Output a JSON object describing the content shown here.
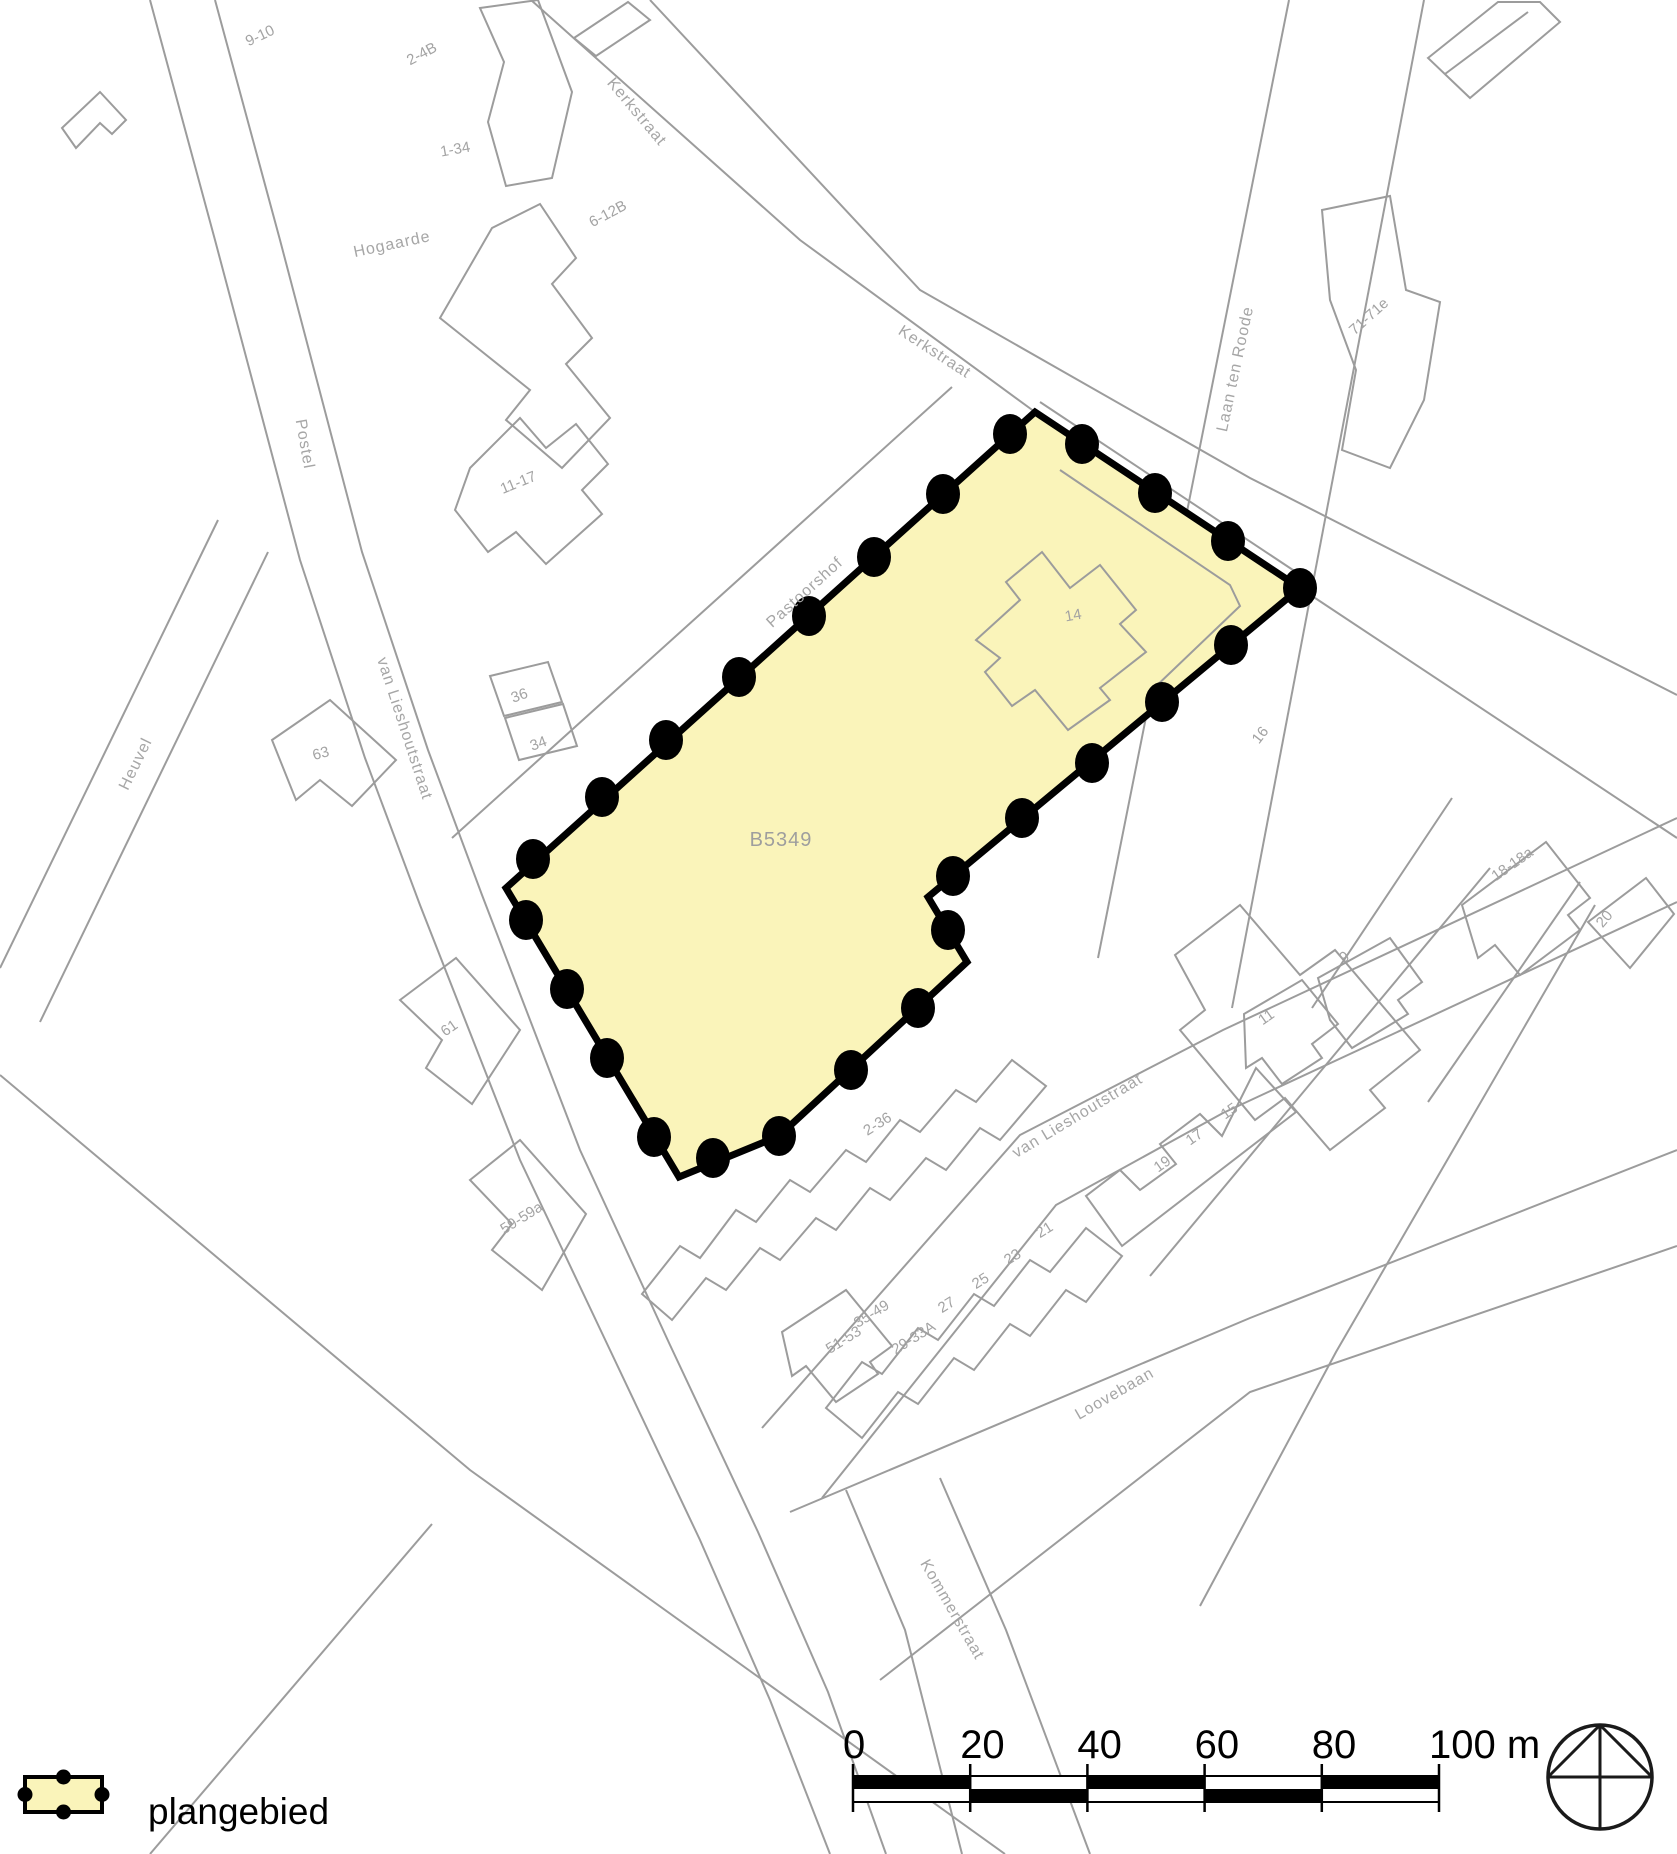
{
  "canvas": {
    "width": 1677,
    "height": 1854
  },
  "colors": {
    "background": "#ffffff",
    "map_line": "#9c9c9c",
    "map_label": "#a6a6a6",
    "plan_fill": "#faf4ba",
    "plan_border": "#000000"
  },
  "plan_area": {
    "parcel_code": "B5349",
    "code_x": 781,
    "code_y": 846,
    "polygon": [
      [
        1035,
        412
      ],
      [
        1300,
        588
      ],
      [
        928,
        897
      ],
      [
        967,
        962
      ],
      [
        779,
        1136
      ],
      [
        679,
        1177
      ],
      [
        506,
        888
      ]
    ],
    "border_width": 7,
    "dots": [
      [
        1082,
        444
      ],
      [
        1155,
        493
      ],
      [
        1228,
        541
      ],
      [
        1300,
        588
      ],
      [
        1231,
        645
      ],
      [
        1162,
        702
      ],
      [
        1092,
        763
      ],
      [
        1022,
        818
      ],
      [
        953,
        876
      ],
      [
        948,
        930
      ],
      [
        918,
        1008
      ],
      [
        851,
        1070
      ],
      [
        779,
        1136
      ],
      [
        713,
        1158
      ],
      [
        654,
        1137
      ],
      [
        607,
        1058
      ],
      [
        567,
        989
      ],
      [
        526,
        920
      ],
      [
        533,
        859
      ],
      [
        602,
        797
      ],
      [
        666,
        740
      ],
      [
        739,
        677
      ],
      [
        809,
        616
      ],
      [
        874,
        557
      ],
      [
        943,
        494
      ],
      [
        1010,
        434
      ]
    ],
    "dot_rx": 17,
    "dot_ry": 20
  },
  "street_labels": [
    {
      "text": "Kerkstraat",
      "x": 633,
      "y": 115,
      "rot": 50
    },
    {
      "text": "Kerkstraat",
      "x": 932,
      "y": 356,
      "rot": 33
    },
    {
      "text": "Laan ten Roode",
      "x": 1240,
      "y": 370,
      "rot": -78
    },
    {
      "text": "Postel",
      "x": 300,
      "y": 445,
      "rot": 80
    },
    {
      "text": "Hogaarde",
      "x": 393,
      "y": 249,
      "rot": -12
    },
    {
      "text": "Heuvel",
      "x": 140,
      "y": 766,
      "rot": -64
    },
    {
      "text": "van Lieshoutstraat",
      "x": 400,
      "y": 730,
      "rot": 72
    },
    {
      "text": "Pastoorshof",
      "x": 808,
      "y": 596,
      "rot": -42
    },
    {
      "text": "van Lieshoutstraat",
      "x": 1080,
      "y": 1120,
      "rot": -31
    },
    {
      "text": "Loovebaan",
      "x": 1117,
      "y": 1398,
      "rot": -30
    },
    {
      "text": "Kommerstraat",
      "x": 948,
      "y": 1612,
      "rot": 60
    }
  ],
  "parcel_labels": [
    {
      "text": "9-10",
      "x": 262,
      "y": 40,
      "rot": -25
    },
    {
      "text": "2-4B",
      "x": 424,
      "y": 58,
      "rot": -28
    },
    {
      "text": "1-34",
      "x": 456,
      "y": 154,
      "rot": -10
    },
    {
      "text": "6-12B",
      "x": 610,
      "y": 218,
      "rot": -28
    },
    {
      "text": "71-71e",
      "x": 1372,
      "y": 320,
      "rot": -42
    },
    {
      "text": "11-17",
      "x": 520,
      "y": 487,
      "rot": -22
    },
    {
      "text": "36",
      "x": 521,
      "y": 700,
      "rot": -20
    },
    {
      "text": "34",
      "x": 540,
      "y": 748,
      "rot": -20
    },
    {
      "text": "63",
      "x": 322,
      "y": 758,
      "rot": -15
    },
    {
      "text": "61",
      "x": 452,
      "y": 1032,
      "rot": -35
    },
    {
      "text": "59-59a",
      "x": 524,
      "y": 1222,
      "rot": -32
    },
    {
      "text": "14",
      "x": 1074,
      "y": 620,
      "rot": -10
    },
    {
      "text": "16",
      "x": 1264,
      "y": 738,
      "rot": -52
    },
    {
      "text": "18-18a",
      "x": 1515,
      "y": 868,
      "rot": -35
    },
    {
      "text": "20",
      "x": 1608,
      "y": 922,
      "rot": -50
    },
    {
      "text": "9",
      "x": 1347,
      "y": 961,
      "rot": -35
    },
    {
      "text": "11",
      "x": 1269,
      "y": 1021,
      "rot": -35
    },
    {
      "text": "15",
      "x": 1232,
      "y": 1115,
      "rot": -35
    },
    {
      "text": "17",
      "x": 1197,
      "y": 1141,
      "rot": -35
    },
    {
      "text": "19",
      "x": 1165,
      "y": 1168,
      "rot": -35
    },
    {
      "text": "2-36",
      "x": 880,
      "y": 1128,
      "rot": -32
    },
    {
      "text": "21",
      "x": 1047,
      "y": 1234,
      "rot": -32
    },
    {
      "text": "23",
      "x": 1015,
      "y": 1261,
      "rot": -32
    },
    {
      "text": "25",
      "x": 983,
      "y": 1285,
      "rot": -32
    },
    {
      "text": "27",
      "x": 949,
      "y": 1309,
      "rot": -32
    },
    {
      "text": "29-33A",
      "x": 916,
      "y": 1342,
      "rot": -32
    },
    {
      "text": "35-49",
      "x": 874,
      "y": 1318,
      "rot": -32
    },
    {
      "text": "51-53",
      "x": 846,
      "y": 1344,
      "rot": -32
    }
  ],
  "roads": [
    "M 531,0 L 800,240 L 1035,412",
    "M 1040,402 L 1308,580",
    "M 1300,588 L 1677,838",
    "M 650,0 L 920,290 L 1250,478 L 1677,695",
    "M 1289,0 L 1098,958",
    "M 1424,0 L 1232,1008",
    "M 150,0 L 215,240 L 300,560 L 365,758 L 420,905 L 520,1160 L 610,1350 L 700,1540 L 770,1700 L 830,1854",
    "M 215,0 L 280,240 L 362,552 L 428,750 L 482,895 L 580,1150 L 670,1345 L 758,1532 L 828,1692 L 886,1854",
    "M 218,520 L 0,968",
    "M 268,552 L 40,1022",
    "M 452,838 L 952,387",
    "M 762,1428 L 1020,1135 L 1223,1030 L 1677,818",
    "M 822,1498 L 1056,1205 L 1223,1113 L 1677,902",
    "M 790,1512 L 1250,1318 L 1677,1150",
    "M 880,1680 L 1250,1392 L 1677,1246",
    "M 846,1490 L 905,1630 L 962,1854",
    "M 940,1478 L 1006,1630 L 1090,1854",
    "M 0,1075 L 470,1470 L 1005,1854",
    "M 150,1854 L 432,1524",
    "M 1490,868 L 1150,1276",
    "M 1595,905 L 1336,1352 L 1200,1606",
    "M 1445,74 L 1528,12",
    "M 1452,798 L 1312,1008",
    "M 1580,882 L 1428,1102"
  ],
  "buildings": [
    {
      "name": "building-9-10",
      "d": "M 480,8 L 538,0 L 572,92 L 552,178 L 506,186 L 488,122 L 504,62 Z"
    },
    {
      "name": "building-1-34",
      "d": "M 440,318 L 492,228 L 540,204 L 576,258 L 552,284 L 592,338 L 566,364 L 610,418 L 562,468 L 506,420 L 530,390 L 480,350 Z"
    },
    {
      "name": "building-11-17",
      "d": "M 470,468 L 520,418 L 546,448 L 576,424 L 608,464 L 582,490 L 602,514 L 546,564 L 516,532 L 488,552 L 455,510 Z"
    },
    {
      "name": "parcel-36",
      "d": "M 490,676 L 548,662 L 562,702 L 504,716 Z"
    },
    {
      "name": "parcel-34",
      "d": "M 505,718 L 563,704 L 577,746 L 519,760 Z"
    },
    {
      "name": "building-63",
      "d": "M 272,740 L 330,700 L 396,760 L 352,806 L 320,780 L 296,800 Z"
    },
    {
      "name": "building-61",
      "d": "M 400,1000 L 456,958 L 520,1030 L 472,1104 L 426,1068 L 442,1040 Z"
    },
    {
      "name": "building-59-59a",
      "d": "M 470,1180 L 520,1140 L 586,1214 L 542,1290 L 492,1250 L 512,1224 Z"
    },
    {
      "name": "building-71-71e",
      "d": "M 1322,210 L 1390,196 L 1406,290 L 1440,302 L 1424,400 L 1390,468 L 1342,450 L 1356,370 L 1330,300 Z"
    },
    {
      "name": "building-16",
      "d": "M 1175,955 L 1240,905 L 1300,975 L 1335,950 L 1420,1050 L 1370,1090 L 1385,1108 L 1330,1150 L 1285,1098 L 1255,1120 L 1180,1030 L 1205,1010 Z"
    },
    {
      "name": "building-18-18a",
      "d": "M 1462,905 L 1546,842 L 1590,898 L 1568,915 L 1580,930 L 1520,975 L 1495,945 L 1478,958 Z"
    },
    {
      "name": "building-20",
      "d": "M 1588,922 L 1646,878 L 1674,914 L 1630,968 Z"
    },
    {
      "name": "building-9",
      "d": "M 1318,978 L 1390,938 L 1422,982 L 1398,1000 L 1408,1014 L 1352,1048 L 1330,1020 Z"
    },
    {
      "name": "building-11",
      "d": "M 1244,1014 L 1302,980 L 1338,1024 L 1312,1044 L 1322,1058 L 1282,1084 L 1262,1058 L 1246,1068 Z"
    },
    {
      "name": "building-19-17-15",
      "d": "M 1256,1068 L 1296,1112 L 1122,1246 L 1086,1196 L 1120,1170 L 1140,1190 L 1176,1164 L 1160,1144 L 1200,1114 L 1222,1136 Z"
    },
    {
      "name": "building-2-36",
      "d": "M 642,1294 L 680,1246 L 700,1258 L 736,1210 L 756,1222 L 790,1180 L 810,1192 L 846,1150 L 866,1162 L 900,1120 L 920,1132 L 956,1090 L 976,1102 L 1012,1060 L 1046,1086 L 1000,1140 L 980,1128 L 946,1170 L 926,1158 L 890,1200 L 870,1188 L 836,1230 L 816,1218 L 780,1260 L 760,1248 L 726,1290 L 706,1278 L 672,1320 Z"
    },
    {
      "name": "building-21-29",
      "d": "M 826,1408 L 862,1362 L 882,1374 L 918,1328 L 938,1340 L 974,1294 L 994,1306 L 1030,1260 L 1050,1272 L 1086,1228 L 1122,1256 L 1086,1302 L 1066,1290 L 1030,1336 L 1010,1324 L 974,1370 L 954,1358 L 918,1404 L 898,1392 L 862,1438 Z"
    },
    {
      "name": "building-51-53",
      "d": "M 782,1332 L 846,1290 L 892,1346 L 870,1362 L 878,1374 L 836,1402 L 806,1366 L 792,1376 Z"
    },
    {
      "name": "building-topleft",
      "d": "M 62,128 L 100,92 L 126,120 L 112,134 L 100,123 L 76,148 Z"
    },
    {
      "name": "building-topright",
      "d": "M 1428,58 L 1498,2 L 1540,2 L 1560,22 L 1470,98 Z"
    },
    {
      "name": "building-topmid",
      "d": "M 574,38 L 628,2 L 650,20 L 596,56 Z"
    }
  ],
  "inner_features": [
    {
      "name": "building-14",
      "d": "M 976,640 L 1020,600 L 1006,582 L 1042,552 L 1070,588 L 1100,565 L 1136,610 L 1120,624 L 1146,652 L 1100,688 L 1110,700 L 1068,730 L 1035,690 L 1012,706 L 985,672 L 1000,658 Z"
    },
    {
      "name": "kerkstraat-inner-edge",
      "d": "M 1060,470 L 1230,585 L 1240,606 L 1150,692"
    }
  ],
  "legend": {
    "label": "plangebied",
    "swatch": {
      "x": 25,
      "y": 1777,
      "w": 77,
      "h": 35,
      "dot_r": 7.5,
      "border_w": 4
    },
    "label_x": 148,
    "label_y": 1824
  },
  "scale_bar": {
    "x0": 853,
    "x1": 1439,
    "y_top": 1776,
    "row_h": 13,
    "tick_top": 1764,
    "tick_bottom": 1812,
    "label_y": 1758,
    "tick_labels": [
      "0",
      "20",
      "40",
      "60",
      "80"
    ],
    "end_label": "100 m",
    "num_segments": 5
  },
  "compass": {
    "cx": 1600,
    "cy": 1777,
    "r": 52
  }
}
